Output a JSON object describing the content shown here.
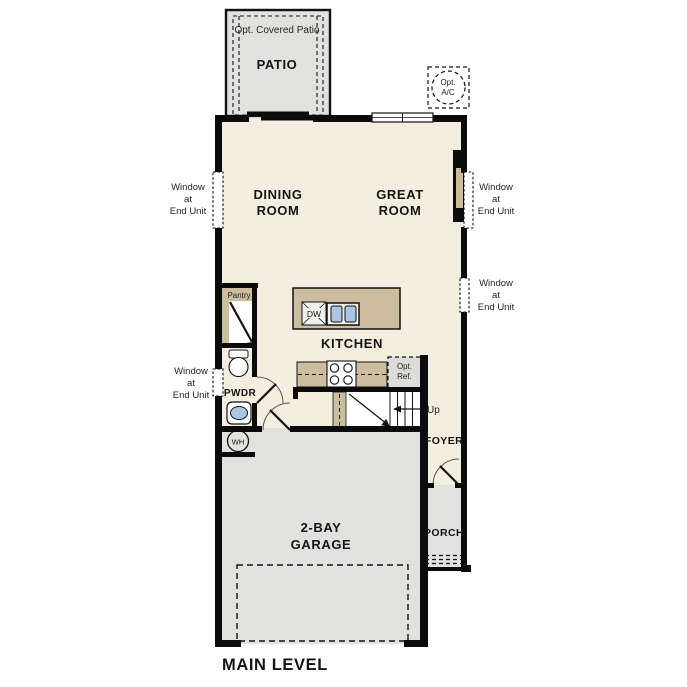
{
  "plan": {
    "level_label": "MAIN LEVEL",
    "rooms": {
      "patio": {
        "label": "PATIO",
        "option": "Opt. Covered Patio"
      },
      "dining_room": {
        "line1": "DINING",
        "line2": "ROOM"
      },
      "great_room": {
        "line1": "GREAT",
        "line2": "ROOM"
      },
      "kitchen": {
        "label": "KITCHEN"
      },
      "pantry": {
        "label": "Pantry"
      },
      "powder_room": {
        "label": "PWDR"
      },
      "foyer": {
        "label": "FOYER"
      },
      "porch": {
        "label": "PORCH"
      },
      "garage": {
        "line1": "2-BAY",
        "line2": "GARAGE"
      }
    },
    "fixtures": {
      "dishwasher": {
        "label": "DW"
      },
      "water_heater": {
        "label": "WH"
      },
      "opt_ac": {
        "line1": "Opt.",
        "line2": "A/C"
      },
      "opt_fridge": {
        "line1": "Opt.",
        "line2": "Ref."
      },
      "stairs": {
        "direction_label": "Up"
      }
    },
    "window_note": {
      "line1": "Window",
      "line2": "at",
      "line3": "End Unit"
    },
    "colors": {
      "floor_cream": "#f4eee1",
      "concrete_gray": "#e1e1df",
      "cabinet_tan": "#ccbd9f",
      "fixture_blue": "#a9c7e5",
      "wall_black": "#0b0b0b"
    }
  }
}
